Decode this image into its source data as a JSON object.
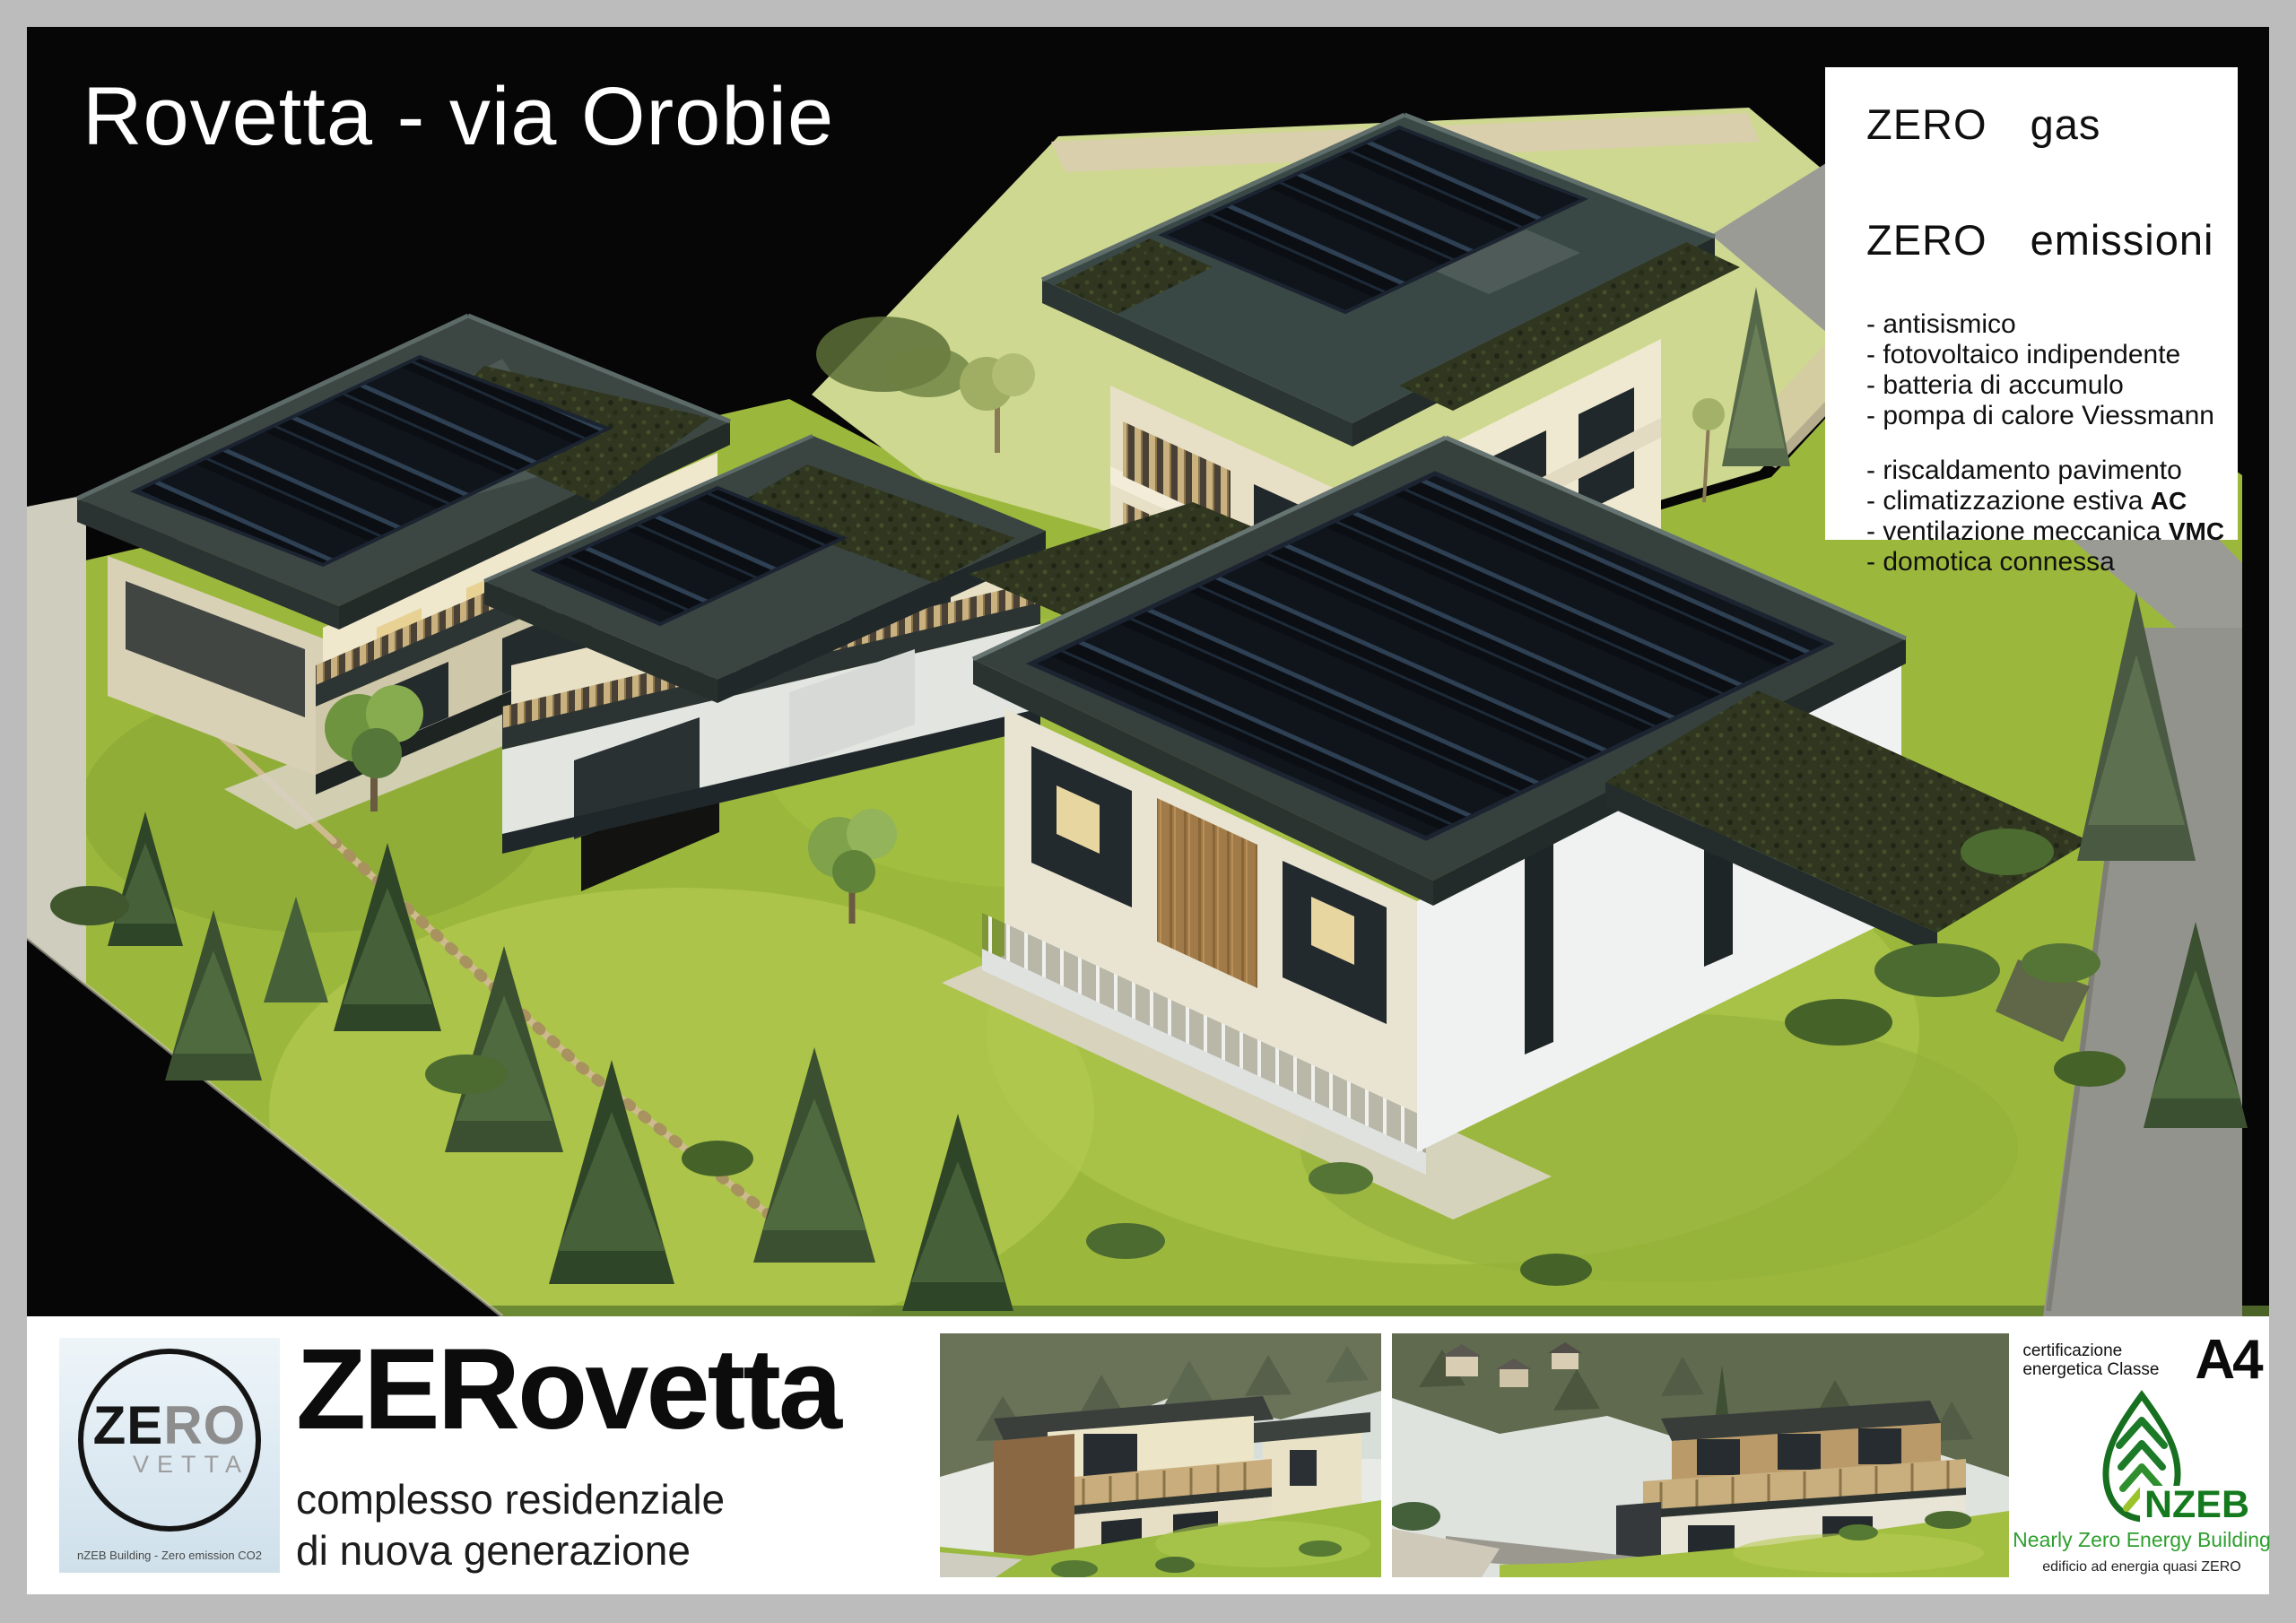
{
  "header": {
    "title": "Rovetta - via Orobie"
  },
  "features": {
    "headlines": [
      {
        "zero": "ZERO",
        "rest": "gas"
      },
      {
        "zero": "ZERO",
        "rest": "emissioni"
      }
    ],
    "items": [
      {
        "text": "- antisismico",
        "suffix": ""
      },
      {
        "text": "- fotovoltaico indipendente",
        "suffix": ""
      },
      {
        "text": "- batteria di accumulo",
        "suffix": ""
      },
      {
        "text": "- pompa di calore Viessmann",
        "suffix": ""
      },
      {
        "text": "- riscaldamento pavimento",
        "suffix": ""
      },
      {
        "text": "- climatizzazione estiva ",
        "suffix": "AC"
      },
      {
        "text": "- ventilazione meccanica ",
        "suffix": "VMC"
      },
      {
        "text": "- domotica connessa",
        "suffix": ""
      }
    ]
  },
  "logo": {
    "part_ze": "ZE",
    "part_ro": "RO",
    "part_vetta": "VETTA",
    "caption": "nZEB Building - Zero emission CO2"
  },
  "brand": {
    "name": "ZERovetta",
    "tagline_line1": "complesso residenziale",
    "tagline_line2": "di nuova generazione"
  },
  "certification": {
    "label": "certificazione energetica Classe",
    "energy_class": "A4",
    "nzeb": "NZEB",
    "line1": "Nearly Zero Energy Building",
    "line2": "edificio ad energia quasi ZERO"
  },
  "colors": {
    "page_border": "#bcbcbc",
    "render_background": "#060606",
    "lawn_green": "#9cb83c",
    "dry_field": "#ced890",
    "roof_slate": "#38433f",
    "solar_panel": "#0b0e13",
    "green_roof": "#30361f",
    "wall_cream": "#eae3c8",
    "nzeb_green_dark": "#157a1e",
    "nzeb_green_light": "#9bc32b",
    "logo_gray": "#8d8d8d"
  }
}
